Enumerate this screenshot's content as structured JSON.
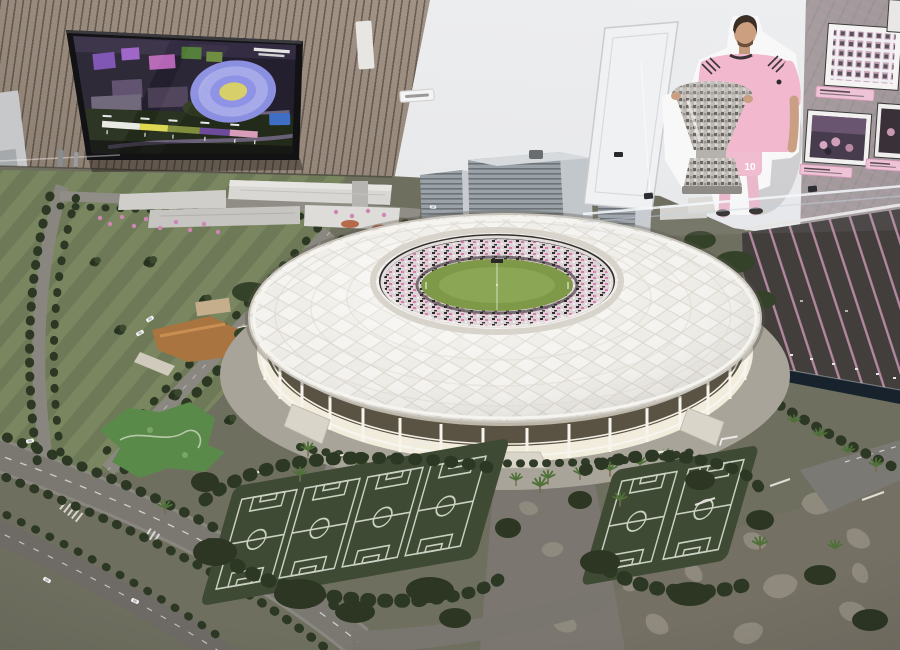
{
  "scene": {
    "alt": "Showroom photo: architectural scale model of a stadium and park district, wall screen with aerial rendering, soccer player cutout holding a trophy, and a wall of framed photos"
  },
  "tv_screen": {
    "screen_bg": "#241f2e",
    "legend_colors": [
      "#e9e9e3",
      "#ddd84e",
      "#7f8d3c",
      "#6d4a9c",
      "#d99cbb"
    ],
    "badge_color": "#3f6fc5"
  },
  "cutout": {
    "jersey_number": "10",
    "jersey_color": "#f2b9ce",
    "shorts_color": "#f0bccf",
    "trophy_color": "#c7c4c0"
  },
  "history_wall": {
    "plaque_color": "#eec3d6"
  },
  "model": {
    "stadium_roof_color": "#eeece6",
    "seat_base_color": "#ded3d6",
    "seat_accent_color": "#d77fae",
    "pitch_color": "#7e9a49",
    "golf_color": "#6e7a57",
    "turf_color": "#3f4a34",
    "field_line_color": "#cbd1c2",
    "canal_color": "#17222d",
    "parking_stripe_color": "#c495ae",
    "umbrella_color": "#cf86b4",
    "training_pitches_left": 4,
    "training_pitches_right": 2
  }
}
